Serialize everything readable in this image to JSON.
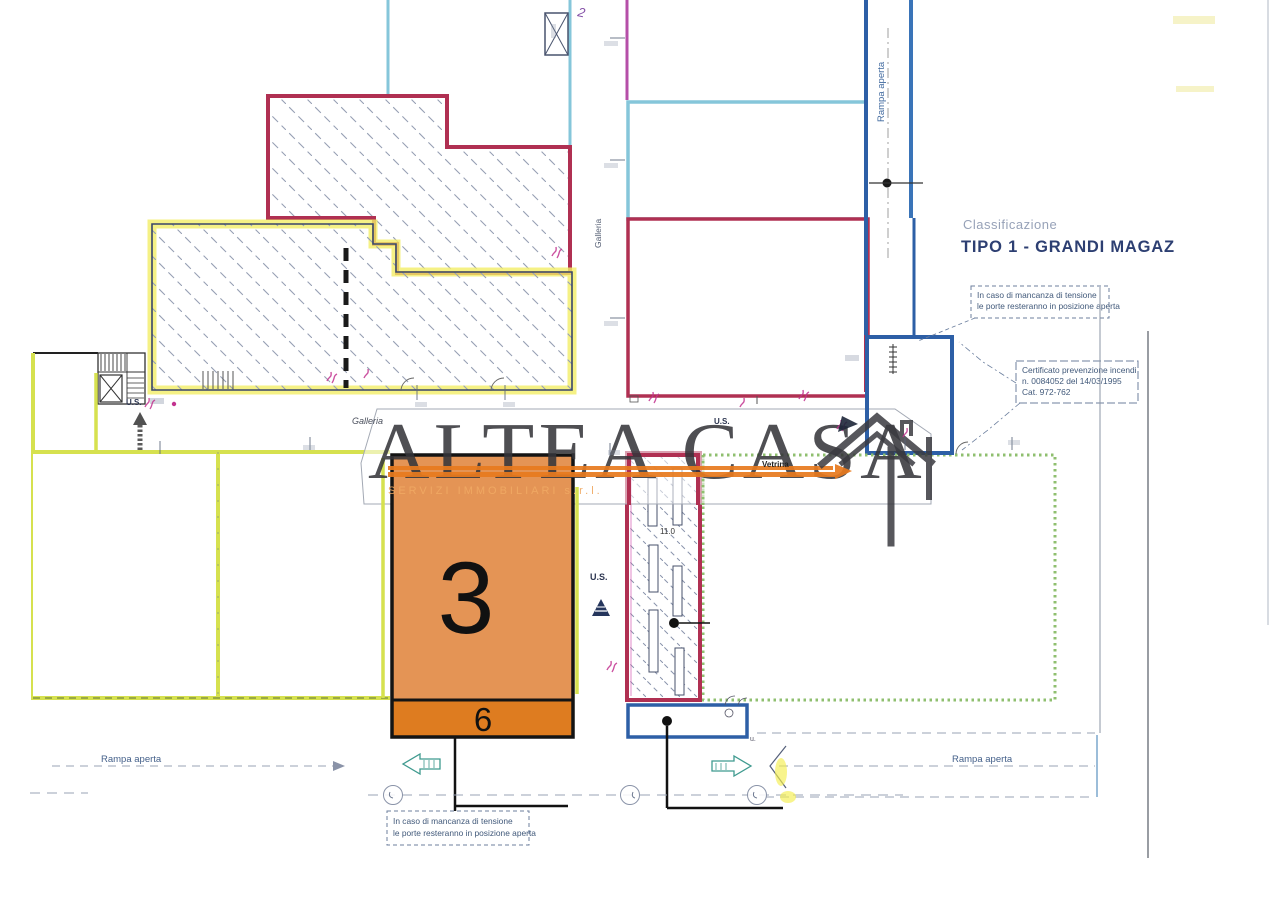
{
  "watermark": {
    "brand": "ALTEA CASA",
    "tagline": "SERVIZI  IMMOBILIARI  s.r.l."
  },
  "classification": {
    "label": "Classificazione",
    "value": "TIPO 1 - GRANDI MAGAZ"
  },
  "notes": {
    "power_top": {
      "line1": "In caso di mancanza di tensione",
      "line2": "le porte resteranno in posizione aperta"
    },
    "certificate": {
      "line1": "Certificato prevenzione incendi",
      "line2": "n. 0084052 del 14/03/1995",
      "line3": "Cat. 972-762"
    },
    "power_bottom": {
      "line1": "In caso di mancanza di tensione",
      "line2": "le porte resteranno in posizione aperta"
    }
  },
  "labels": {
    "ramp_top": "Rampa aperta",
    "ramp_bottom_left": "Rampa aperta",
    "ramp_bottom_right": "Rampa aperta",
    "gallery_vertical": "Galleria",
    "gallery_horizontal": "Galleria",
    "vetrina": "Vetrina",
    "us_stairs": "U.S.",
    "us_center": "U.S.",
    "us_right": "U.S.",
    "unit_number": "3",
    "unit_sub_number": "6",
    "hand_note": "2",
    "escalator_dim": "11.0",
    "u_mark": "u."
  },
  "colors": {
    "unit_fill": "#e49455",
    "unit_strip": "#de7c20",
    "crimson": "#b03052",
    "cyan": "#85c6da",
    "blue": "#2d5fa6",
    "yellow_highlight": "#f2ee66",
    "yellow_green": "#d6e14f",
    "green_dotted": "#8fbf6f",
    "watermark_orange": "#e87a1e",
    "navy_text": "#2d3f72"
  }
}
